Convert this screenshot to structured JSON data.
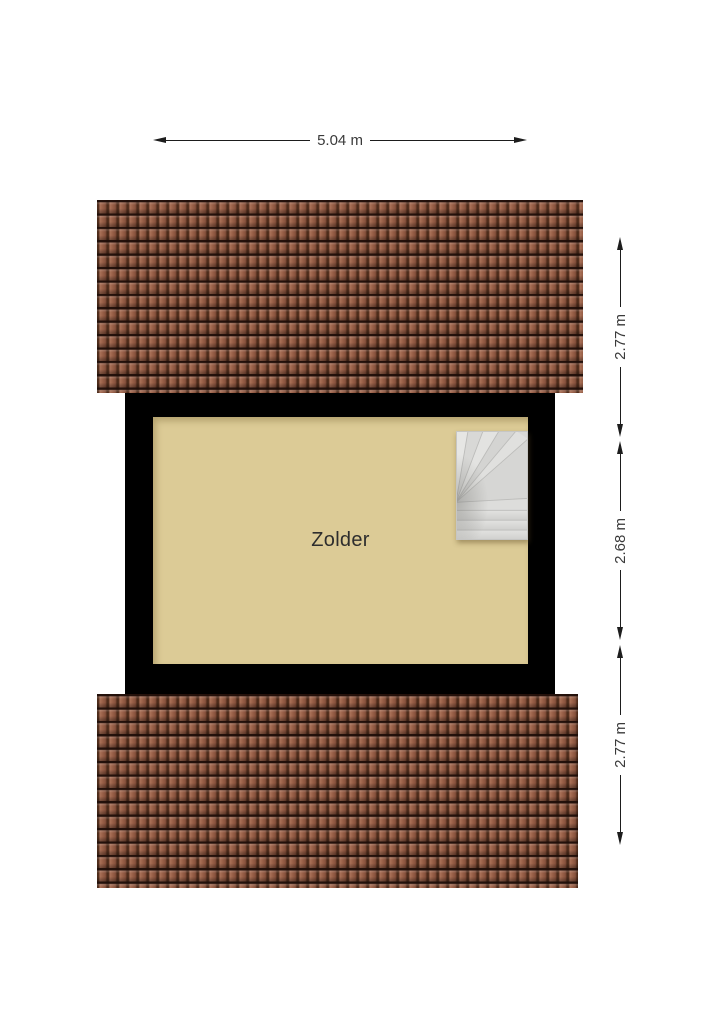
{
  "plan": {
    "room_label": "Zolder",
    "dim_width": "5.04 m",
    "dim_right": [
      {
        "label": "2.77 m"
      },
      {
        "label": "2.68 m"
      },
      {
        "label": "2.77 m"
      }
    ]
  },
  "icons": {
    "staircase": "winder-staircase",
    "arrowheads": "dimension-arrow"
  },
  "colors": {
    "background": "#ffffff",
    "floor": "#dccb96",
    "wall": "#000000",
    "roof_tile": "#9a6149",
    "roof_groove": "#4e2c1b",
    "stair_fill": "#d9d9d7",
    "stair_line": "#bcbcba",
    "dim_line": "#1d1d1d",
    "dim_text": "#3a3a3a",
    "room_text": "#2e2e2e"
  }
}
